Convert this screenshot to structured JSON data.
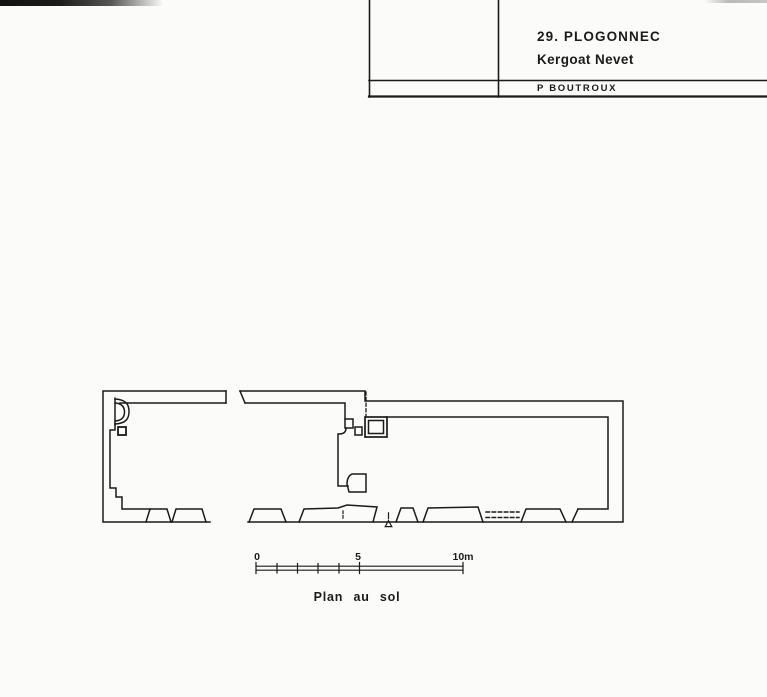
{
  "title_block": {
    "commune_label": "29. PLOGONNEC",
    "site_label": "Kergoat Nevet",
    "author_label": "P BOUTROUX"
  },
  "plan": {
    "caption": "Plan au sol",
    "scale_bar": {
      "tick_0_label": "0",
      "tick_5_label": "5",
      "tick_10_label": "10m"
    }
  },
  "colors": {
    "ink": "#1b1b1b",
    "paper": "#fbfbf9"
  }
}
